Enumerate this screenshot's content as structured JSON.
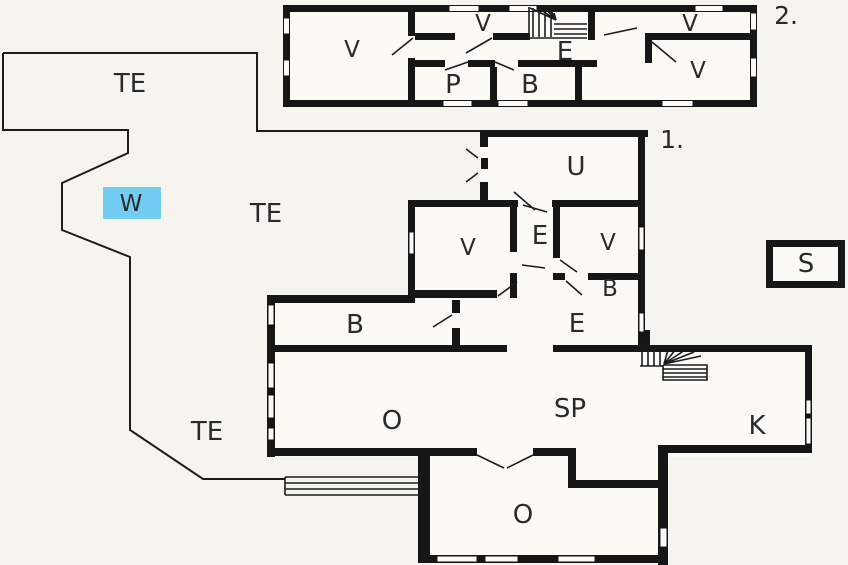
{
  "plan_type": "floor-plan",
  "colors": {
    "background": "#f5f4ee",
    "floor": "#fbfaf5",
    "wall": "#161616",
    "thin_line": "#1c1c1c",
    "marker_fill": "#73ccf1",
    "label": "#2a2a2a"
  },
  "floor2": {
    "number_label": "2.",
    "room_labels": [
      "V",
      "V",
      "E",
      "P",
      "B",
      "V",
      "V"
    ]
  },
  "floor1": {
    "number_label": "1.",
    "room_labels": [
      "TE",
      "W",
      "TE",
      "U",
      "V",
      "E",
      "V",
      "B",
      "B",
      "E",
      "O",
      "SP",
      "K",
      "TE",
      "O"
    ]
  },
  "outbuilding": {
    "room_labels": [
      "S"
    ]
  }
}
